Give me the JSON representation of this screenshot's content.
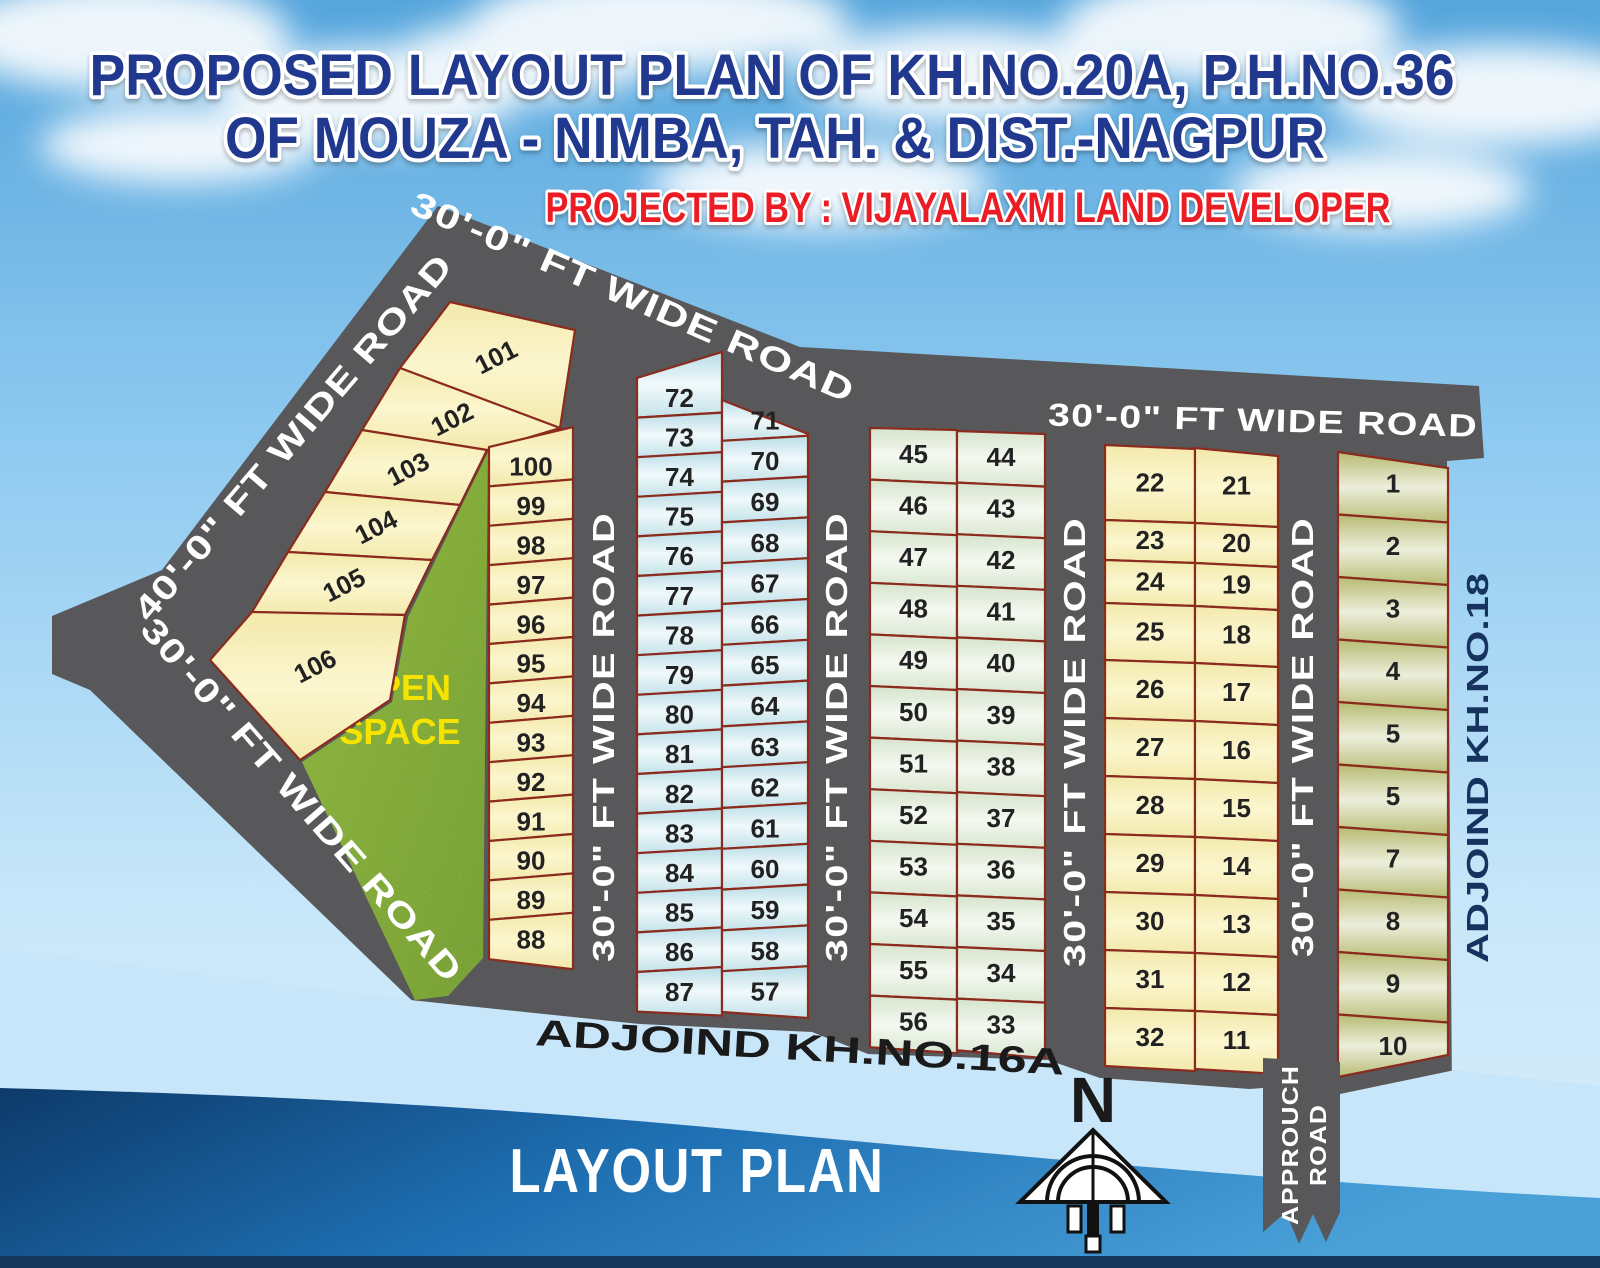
{
  "title": {
    "line1": "PROPOSED LAYOUT PLAN OF KH.NO.20A, P.H.NO.36",
    "line2": "OF MOUZA - NIMBA, TAH. & DIST.-NAGPUR",
    "projected_by": "PROJECTED BY  :  VIJAYALAXMI LAND DEVELOPER"
  },
  "plan": {
    "road_label_40": "40'-0\" FT WIDE ROAD",
    "road_label_30": "30'-0\" FT WIDE ROAD",
    "open_space_line1": "OPEN",
    "open_space_line2": "SPACE",
    "adjoining_bottom": "ADJOIND KH.NO.16A",
    "adjoining_right": "ADJOIND KH.NO.18",
    "approach_road_line1": "APPROUCH",
    "approach_road_line2": "ROAD",
    "north_marker": "N",
    "caption": "LAYOUT PLAN"
  },
  "plots": {
    "strip_101_106": [
      "101",
      "102",
      "103",
      "104",
      "105",
      "106"
    ],
    "col_100_88": [
      "100",
      "99",
      "98",
      "97",
      "96",
      "95",
      "94",
      "93",
      "92",
      "91",
      "90",
      "89",
      "88"
    ],
    "col_72_87": [
      "72",
      "73",
      "74",
      "75",
      "76",
      "77",
      "78",
      "79",
      "80",
      "81",
      "82",
      "83",
      "84",
      "85",
      "86",
      "87"
    ],
    "col_71_57": [
      "71",
      "70",
      "69",
      "68",
      "67",
      "66",
      "65",
      "64",
      "63",
      "62",
      "61",
      "60",
      "59",
      "58",
      "57"
    ],
    "col_45_56": [
      "45",
      "46",
      "47",
      "48",
      "49",
      "50",
      "51",
      "52",
      "53",
      "54",
      "55",
      "56"
    ],
    "col_44_33": [
      "44",
      "43",
      "42",
      "41",
      "40",
      "39",
      "38",
      "37",
      "36",
      "35",
      "34",
      "33"
    ],
    "col_22_32": [
      "22",
      "23",
      "24",
      "25",
      "26",
      "27",
      "28",
      "29",
      "30",
      "31",
      "32"
    ],
    "col_21_11": [
      "21",
      "20",
      "19",
      "18",
      "17",
      "16",
      "15",
      "14",
      "13",
      "12",
      "11"
    ],
    "col_1_10": [
      "1",
      "2",
      "3",
      "4",
      "5",
      "5",
      "7",
      "8",
      "9",
      "10"
    ]
  },
  "colors": {
    "road_gray": "#58585a",
    "plot_border": "#8b2b1d",
    "title_blue": "#21388f",
    "accent_red": "#ec1c24",
    "open_space_text": "#f6e400",
    "sky_blue": "#58a7dd",
    "water_blue": "#2f8fd0",
    "plot_yellow": "#faf2c0",
    "plot_blue": "#cfe6ec",
    "plot_green": "#dde9d6",
    "plot_olive": "#bfc379"
  }
}
